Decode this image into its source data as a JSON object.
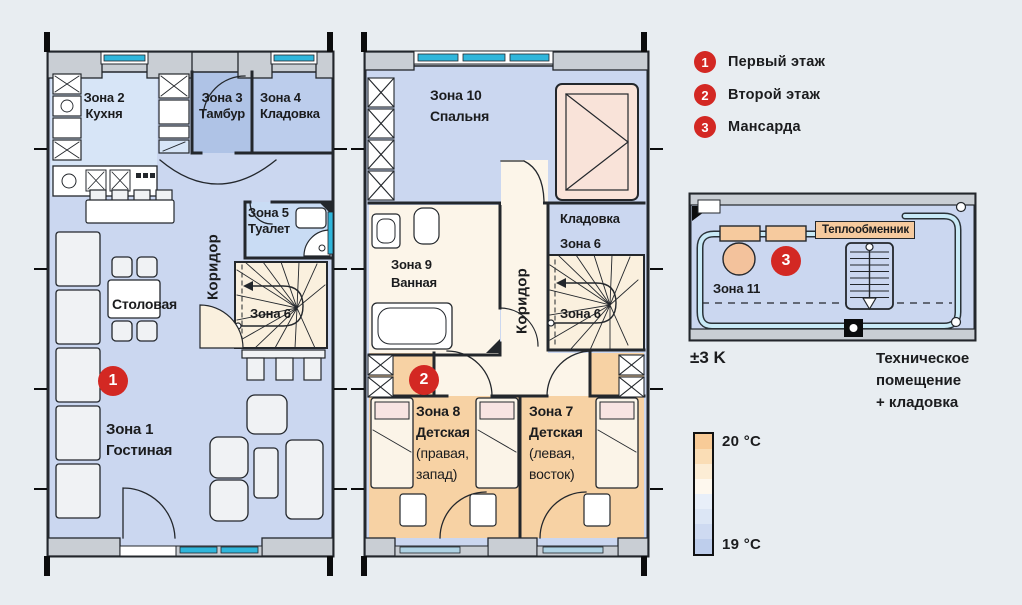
{
  "colors": {
    "bg": "#E8EDF1",
    "accent-red": "#D32823",
    "text": "#1B1C1E",
    "wall-gray": "#C9CED4",
    "line": "#23272C",
    "room-main": "#CBD7F0",
    "room-kitchen": "#D7E5F7",
    "room-tambour": "#AFC3E6",
    "room-storage": "#BCCDEC",
    "room-toilet": "#C9DCF4",
    "cream": "#FAF0DE",
    "cream-light": "#FCF5E9",
    "room-child": "#F7D2A4",
    "bed-pink": "#F9E3D9",
    "pillow": "#F8E4E2",
    "furniture": "#F0F2F4",
    "window-cyan": "#2FB6DB",
    "window-pale": "#AFD3E4",
    "pipe": "#C9EAF7",
    "orange-elem": "#F6CA9E",
    "tank": "#F3C29C"
  },
  "legend": {
    "items": [
      {
        "num": "1",
        "label": "Первый этаж"
      },
      {
        "num": "2",
        "label": "Второй этаж"
      },
      {
        "num": "3",
        "label": "Мансарда"
      }
    ]
  },
  "floor1": {
    "marker": "1",
    "zone2": {
      "l1": "Зона 2",
      "l2": "Кухня"
    },
    "zone3": {
      "l1": "Зона 3",
      "l2": "Тамбур"
    },
    "zone4": {
      "l1": "Зона 4",
      "l2": "Кладовка"
    },
    "zone5": {
      "l1": "Зона 5",
      "l2": "Туалет"
    },
    "corridor": "Коридор",
    "dining": "Столовая",
    "stairs": "Зона 6",
    "zone1": {
      "l1": "Зона 1",
      "l2": "Гостиная"
    }
  },
  "floor2": {
    "marker": "2",
    "zone10": {
      "l1": "Зона 10",
      "l2": "Спальня"
    },
    "storage": {
      "l1": "Кладовка",
      "l2": "Зона 6"
    },
    "zone9": {
      "l1": "Зона 9",
      "l2": "Ванная"
    },
    "corridor": "Коридор",
    "stairs": "Зона 6",
    "zone8": {
      "l1": "Зона 8",
      "l2": "Детская",
      "l3": "(правая,",
      "l4": "запад)"
    },
    "zone7": {
      "l1": "Зона 7",
      "l2": "Детская",
      "l3": "(левая,",
      "l4": "восток)"
    }
  },
  "mansarda": {
    "marker": "3",
    "zone11": "Зона 11",
    "heat_exchanger": "Теплообменник",
    "tolerance": "±3 K",
    "caption": {
      "l1": "Техническое",
      "l2": "помещение",
      "l3": "+ кладовка"
    }
  },
  "scale": {
    "top": "20 °C",
    "bottom": "19 °C",
    "bands": [
      "#F8CB97",
      "#FADDB5",
      "#FCEDD5",
      "#FEF8EE",
      "#E8EFF9",
      "#DCE6F5",
      "#CEDAF1",
      "#BECEEC"
    ]
  }
}
